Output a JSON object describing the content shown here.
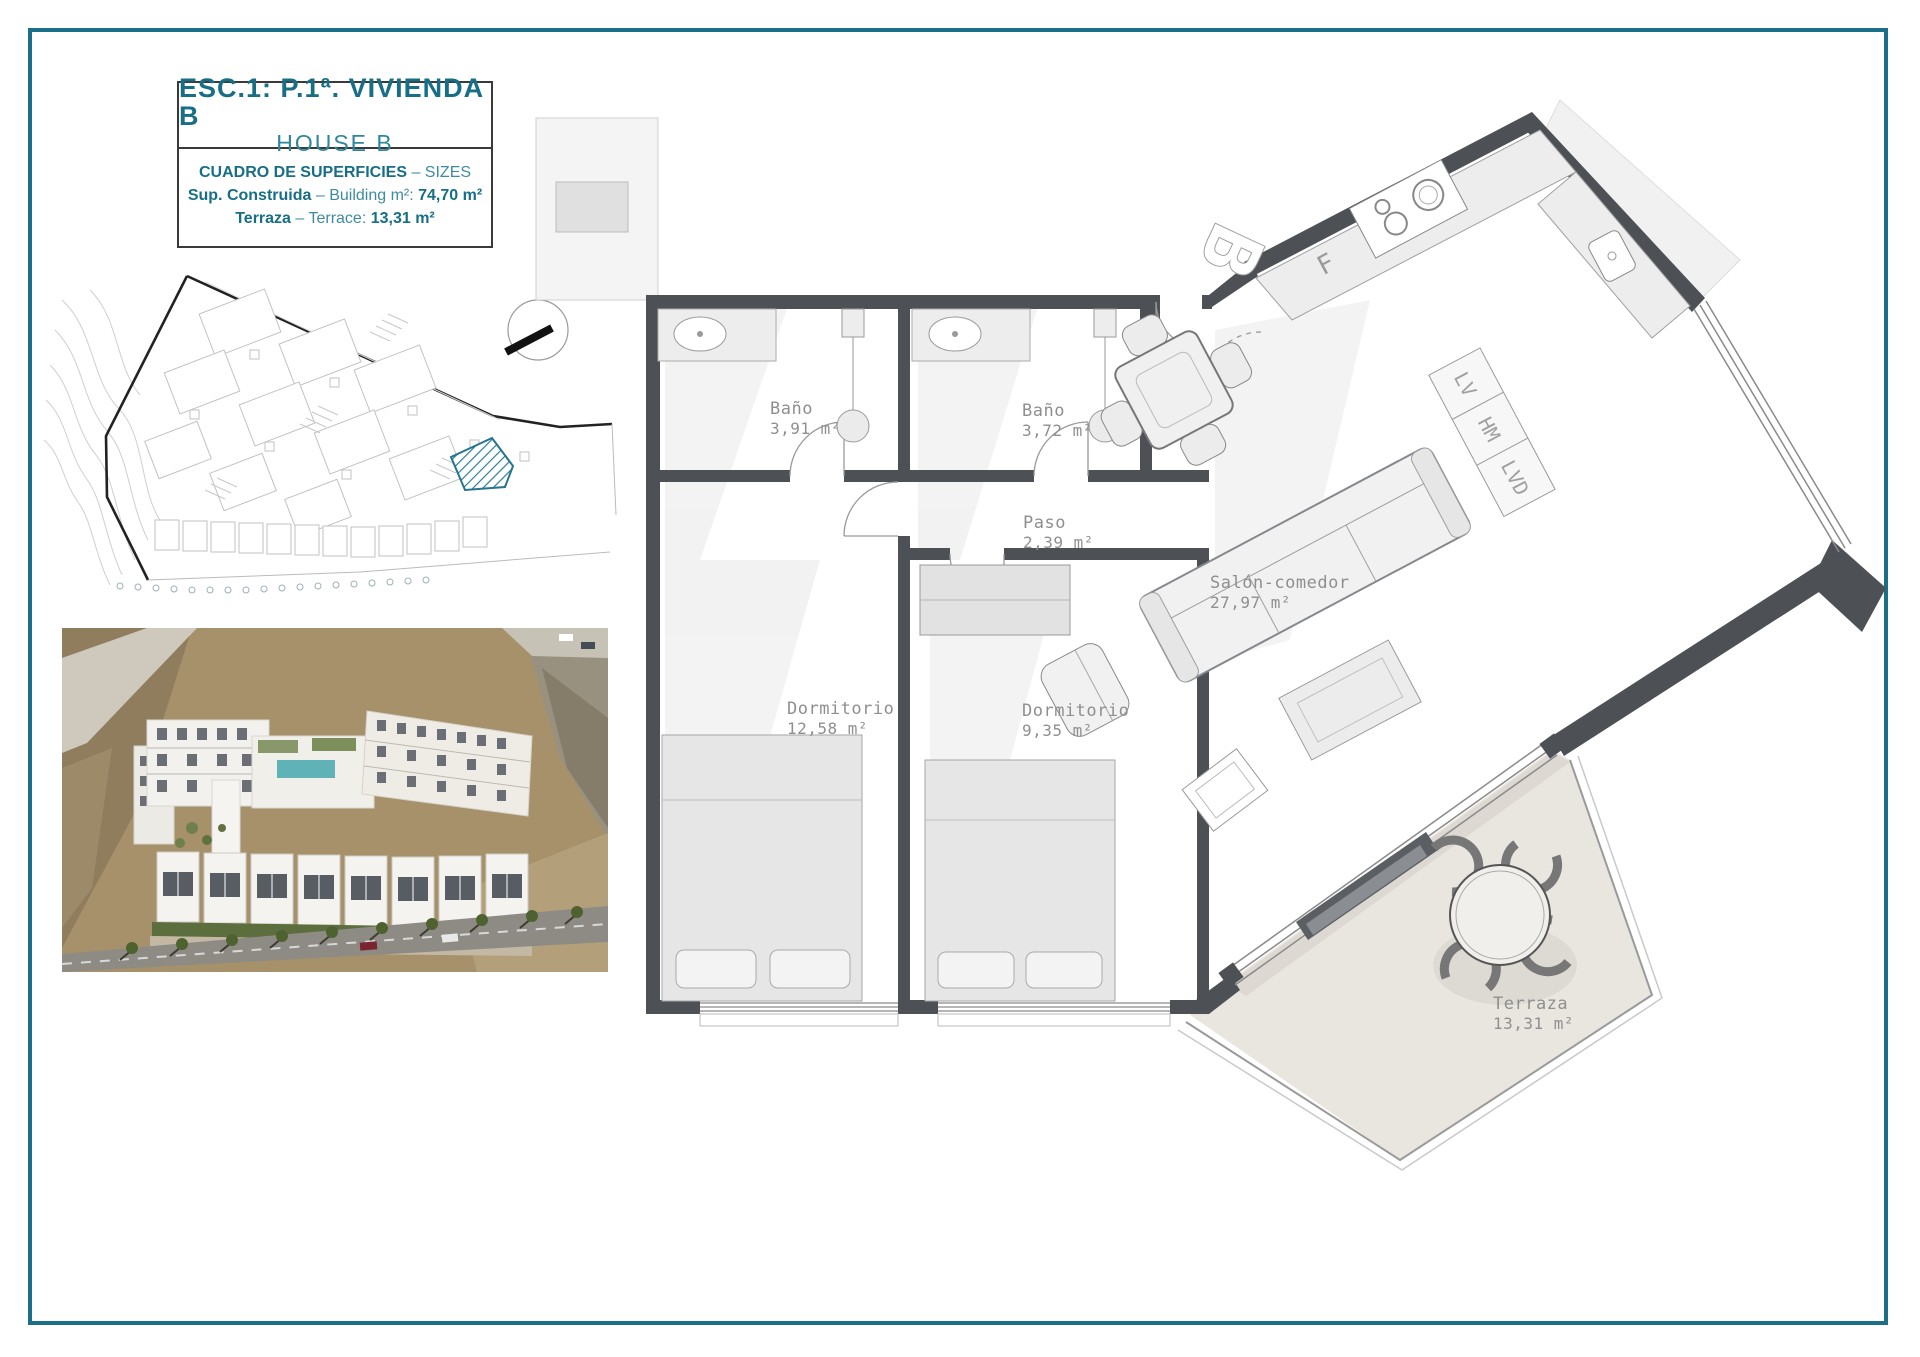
{
  "page": {
    "background": "#ffffff",
    "frame_color": "#1a7187"
  },
  "title_block": {
    "line1": "ESC.1: P.1ª. VIVIENDA B",
    "line2": "HOUSE B",
    "table_header_primary": "CUADRO DE SUPERFICIES",
    "table_header_secondary": "– SIZES",
    "rows": [
      {
        "label": "Sup. Construida",
        "descriptor": "– Building m²:",
        "value": "74,70 m²"
      },
      {
        "label": "Terraza",
        "descriptor": "– Terrace:",
        "value": "13,31 m²"
      }
    ]
  },
  "floor_plan": {
    "unit_marker": "B",
    "kitchen_fridge_label": "F",
    "appliance_labels": [
      "LV",
      "HM",
      "LVD"
    ],
    "rooms": [
      {
        "name": "Baño",
        "area": "3,91 m²"
      },
      {
        "name": "Baño",
        "area": "3,72 m²"
      },
      {
        "name": "Paso",
        "area": "2,39 m²"
      },
      {
        "name": "Dormitorio",
        "area": "12,58 m²"
      },
      {
        "name": "Dormitorio",
        "area": "9,35 m²"
      },
      {
        "name": "Salón-comedor",
        "area": "27,97 m²"
      },
      {
        "name": "Terraza",
        "area": "13,31 m²"
      }
    ]
  },
  "colors": {
    "wall": "#4d5055",
    "furniture_fill": "#efefef",
    "furniture_stroke": "#9a9a9a",
    "label_gray": "#8f8f8f",
    "terrace_fill": "#e9e5df",
    "highlight_teal": "#2a7d93"
  }
}
